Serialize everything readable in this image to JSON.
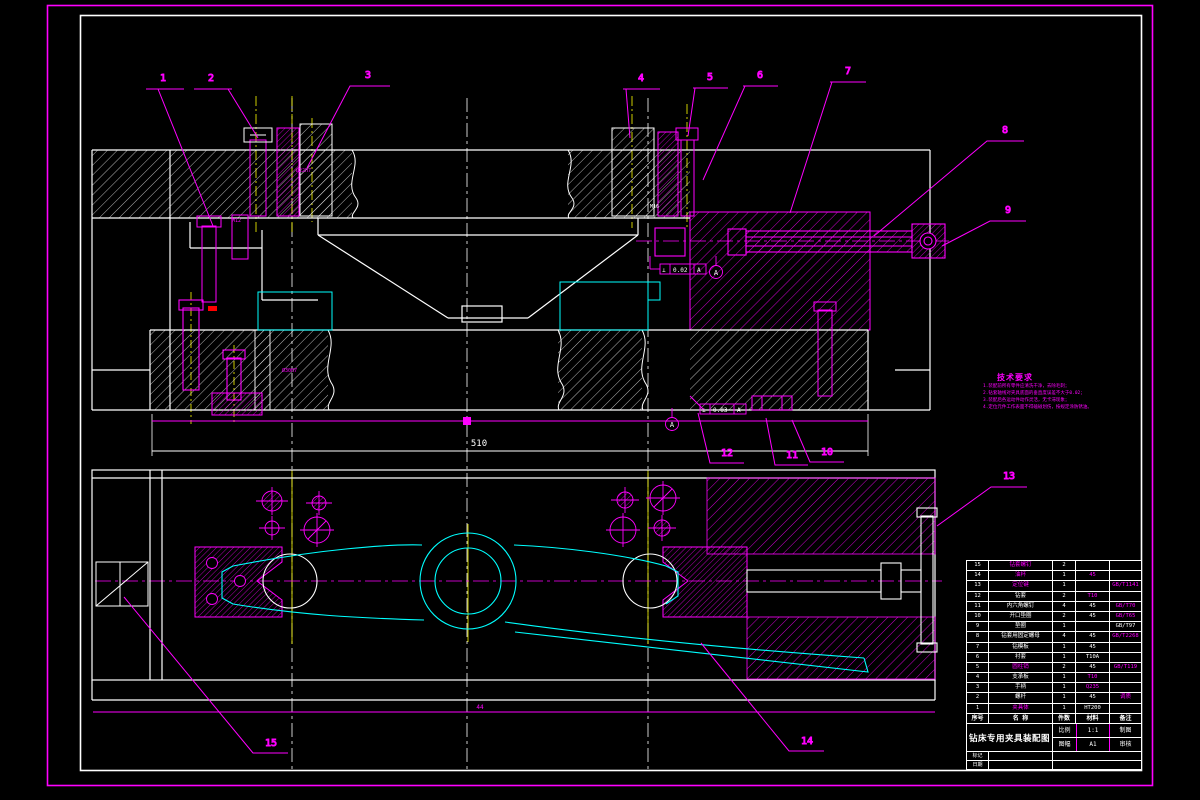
{
  "colors": {
    "background": "#000000",
    "line_white": "#ffffff",
    "line_magenta": "#ff00ff",
    "line_cyan": "#00ffff",
    "line_yellow": "#ffff00",
    "accent_red": "#ff0000"
  },
  "balloons": [
    {
      "label": "1"
    },
    {
      "label": "2"
    },
    {
      "label": "3"
    },
    {
      "label": "4"
    },
    {
      "label": "5"
    },
    {
      "label": "6"
    },
    {
      "label": "7"
    },
    {
      "label": "8"
    },
    {
      "label": "9"
    },
    {
      "label": "10"
    },
    {
      "label": "11"
    },
    {
      "label": "12"
    },
    {
      "label": "13"
    },
    {
      "label": "14"
    },
    {
      "label": "15"
    }
  ],
  "dims": {
    "overall_width": "510",
    "base_height": "44"
  },
  "small_dims": {
    "bushing": "Ø22H7",
    "thread": "M12",
    "bore": "Ø30H7",
    "screw": "M16"
  },
  "tolerances": [
    {
      "symbol": "⊥",
      "value": "0.02",
      "datum": "A"
    },
    {
      "symbol": "⊥",
      "value": "0.03",
      "datum": "A"
    }
  ],
  "datum": {
    "letter": "A"
  },
  "tech_requirements": {
    "title": "技术要求",
    "lines": [
      "1.装配前所有零件应清洗干净，去除毛刺；",
      "2.钻套轴线对夹具底面的垂直度误差不大于0.02；",
      "3.装配后各运动件动作灵活，无卡滞现象；",
      "4.定位元件工作表面不得磕碰划伤，按规定涂防锈油。"
    ]
  },
  "title_block": {
    "header": {
      "no": "序号",
      "name": "名  称",
      "qty": "件数",
      "material": "材料",
      "remark": "备注"
    },
    "rows": [
      {
        "no": "15",
        "name": "钻套螺钉",
        "name_c": "m",
        "qty": "2",
        "mat": "",
        "mat_c": "w",
        "rem": "",
        "rem_c": "m"
      },
      {
        "no": "14",
        "name": "油杯",
        "name_c": "m",
        "qty": "1",
        "mat": "45",
        "mat_c": "m",
        "rem": "",
        "rem_c": "m"
      },
      {
        "no": "13",
        "name": "定位键",
        "name_c": "m",
        "qty": "1",
        "mat": "",
        "mat_c": "w",
        "rem": "GB/T1141",
        "rem_c": "m"
      },
      {
        "no": "12",
        "name": "钻套",
        "name_c": "w",
        "qty": "2",
        "mat": "T10",
        "mat_c": "m",
        "rem": "",
        "rem_c": "m"
      },
      {
        "no": "11",
        "name": "内六角螺钉",
        "name_c": "w",
        "qty": "4",
        "mat": "45",
        "mat_c": "w",
        "rem": "GB/T70",
        "rem_c": "m"
      },
      {
        "no": "10",
        "name": "开口垫圈",
        "name_c": "w",
        "qty": "2",
        "mat": "45",
        "mat_c": "w",
        "rem": "GB/T65",
        "rem_c": "m"
      },
      {
        "no": "9",
        "name": "垫圈",
        "name_c": "w",
        "qty": "1",
        "mat": "",
        "mat_c": "w",
        "rem": "GB/T97",
        "rem_c": "w"
      },
      {
        "no": "8",
        "name": "钻套用固定螺母",
        "name_c": "w",
        "qty": "4",
        "mat": "45",
        "mat_c": "w",
        "rem": "GB/T2268",
        "rem_c": "m"
      },
      {
        "no": "7",
        "name": "钻模板",
        "name_c": "w",
        "qty": "1",
        "mat": "45",
        "mat_c": "w",
        "rem": "",
        "rem_c": "m"
      },
      {
        "no": "6",
        "name": "衬套",
        "name_c": "w",
        "qty": "1",
        "mat": "T10A",
        "mat_c": "w",
        "rem": "",
        "rem_c": "m"
      },
      {
        "no": "5",
        "name": "圆柱销",
        "name_c": "m",
        "qty": "2",
        "mat": "45",
        "mat_c": "w",
        "rem": "GB/T119",
        "rem_c": "m"
      },
      {
        "no": "4",
        "name": "支承板",
        "name_c": "w",
        "qty": "1",
        "mat": "T10",
        "mat_c": "m",
        "rem": "",
        "rem_c": "m"
      },
      {
        "no": "3",
        "name": "手柄",
        "name_c": "w",
        "qty": "1",
        "mat": "Q235",
        "mat_c": "m",
        "rem": "",
        "rem_c": "m"
      },
      {
        "no": "2",
        "name": "螺杆",
        "name_c": "w",
        "qty": "1",
        "mat": "45",
        "mat_c": "w",
        "rem": "调质",
        "rem_c": "m"
      },
      {
        "no": "1",
        "name": "夹具体",
        "name_c": "m",
        "qty": "1",
        "mat": "HT200",
        "mat_c": "w",
        "rem": "",
        "rem_c": "m"
      }
    ],
    "title": "钻床专用夹具装配图",
    "info_rows": [
      {
        "label": "比例",
        "value": "1:1",
        "right": "制图"
      },
      {
        "label": "图幅",
        "value": "A1",
        "right": "审核"
      }
    ],
    "footer_rows": [
      {
        "label": "标记"
      },
      {
        "label": "日期"
      }
    ]
  }
}
